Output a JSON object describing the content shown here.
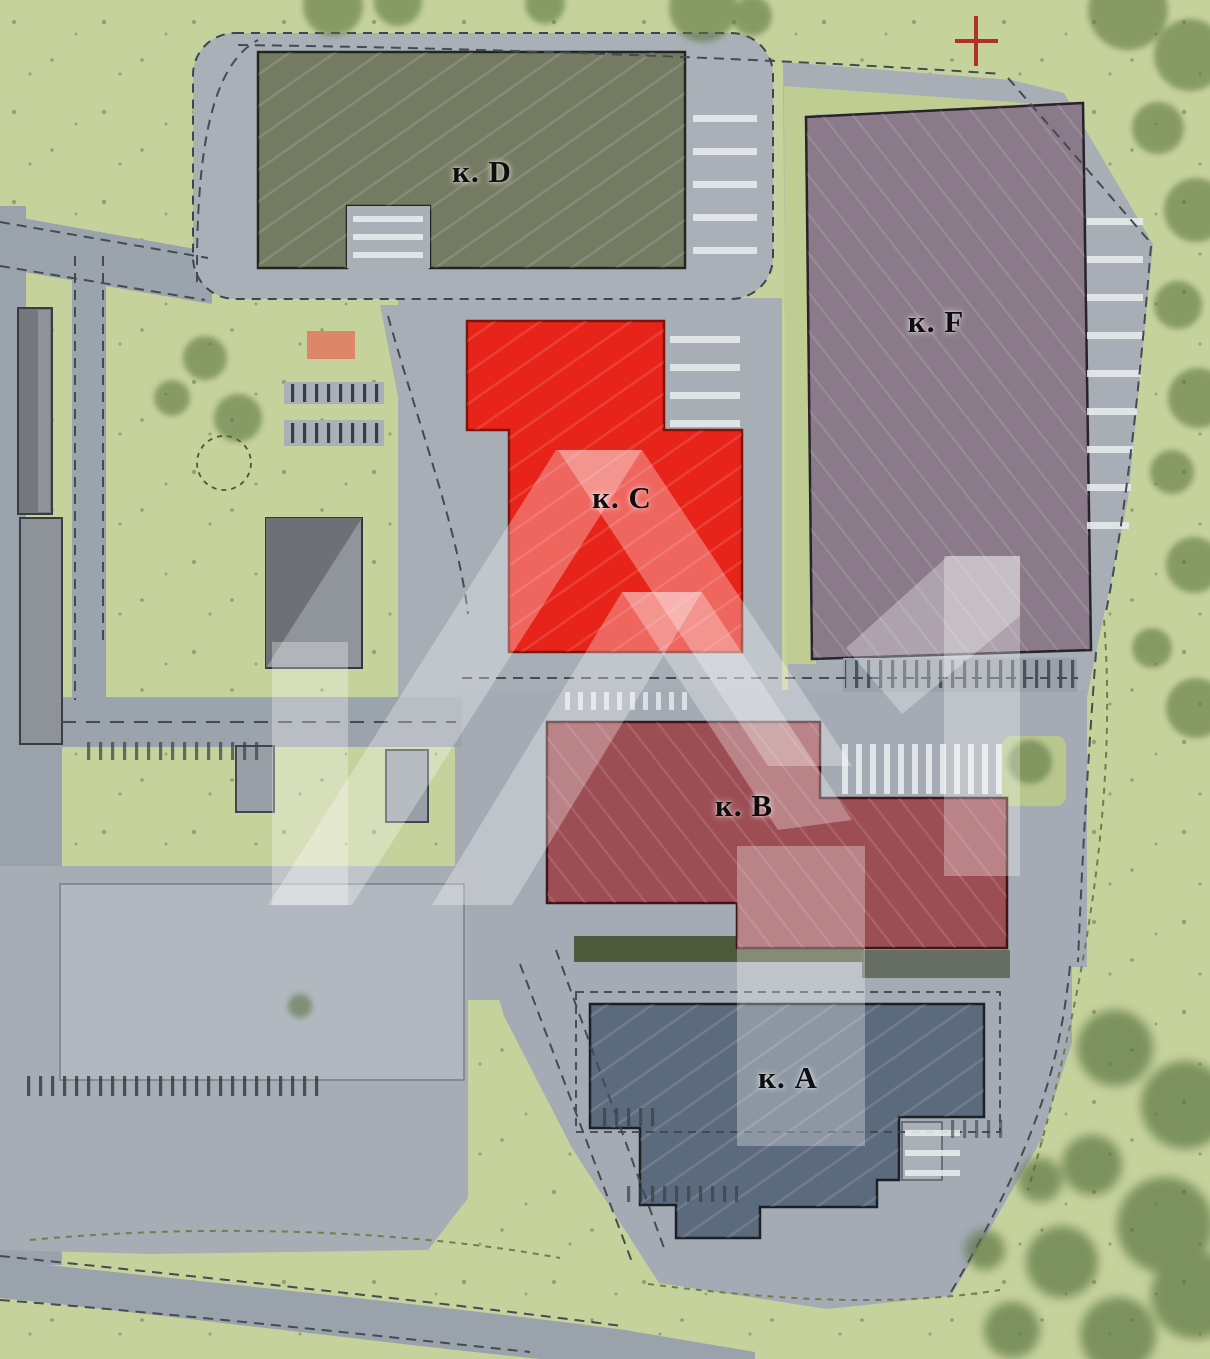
{
  "site_plan": {
    "buildings": [
      {
        "id": "D",
        "label": "к. D",
        "color": "#757b62",
        "state": "normal"
      },
      {
        "id": "F",
        "label": "к. F",
        "color": "#8b7b8a",
        "state": "normal"
      },
      {
        "id": "C",
        "label": "к. C",
        "color": "#e8241a",
        "state": "highlighted"
      },
      {
        "id": "B",
        "label": "к. B",
        "color": "#9c4e54",
        "state": "normal"
      },
      {
        "id": "A",
        "label": "к. A",
        "color": "#5b6a7c",
        "state": "normal"
      }
    ],
    "markers": {
      "cross_marker": {
        "icon": "plus-cross-icon",
        "color": "#b23126"
      },
      "entrance_highlight": {
        "icon": "rect-highlight-icon",
        "color": "#de8064"
      }
    },
    "watermark": {
      "icon": "roofs-logo-watermark-icon",
      "color": "#ffffff"
    },
    "colors": {
      "grass": "#c6d29c",
      "road": "#a7aeb6",
      "parking": "#b1b8bf",
      "trees": "#5a7340",
      "highlight": "#e8241a"
    }
  }
}
